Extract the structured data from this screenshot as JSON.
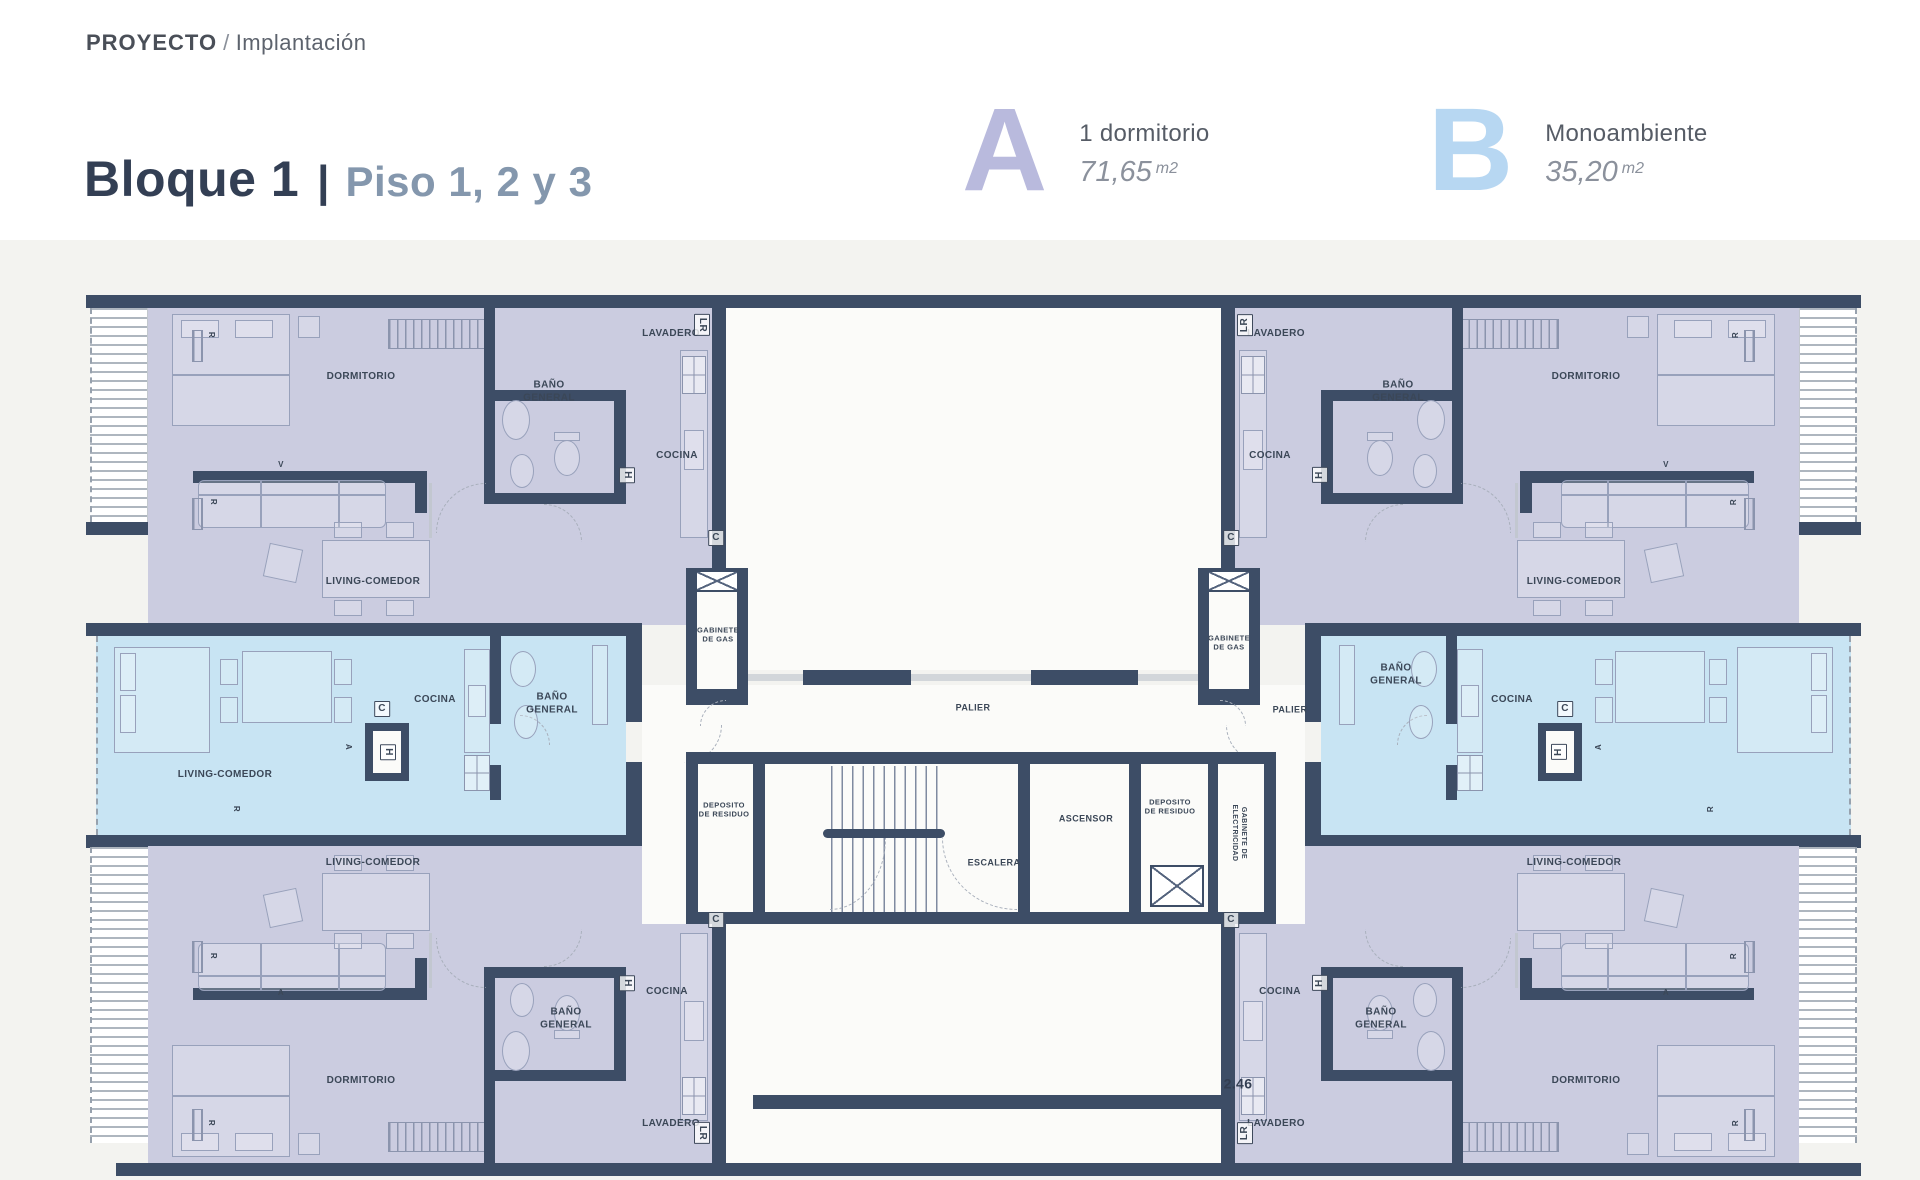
{
  "header": {
    "project_label": "PROYECTO",
    "separator": "/",
    "section_label": "Implantación",
    "block_title": "Bloque 1",
    "title_divider": "|",
    "floors_label": "Piso 1, 2 y 3"
  },
  "legend": [
    {
      "letter": "A",
      "type": "1 dormitorio",
      "area": "71,65",
      "area_unit": "m2",
      "letter_color": "#b9badd"
    },
    {
      "letter": "B",
      "type": "Monoambiente",
      "area": "35,20",
      "area_unit": "m2",
      "letter_color": "#b7d7f2"
    }
  ],
  "plan": {
    "wall_color": "#3d4d66",
    "unit_a_color": "#cbcce0",
    "unit_b_color": "#c8e4f3",
    "dimension": "2.46",
    "labels": [
      {
        "t": "LAVADERO",
        "x": 585,
        "y": 39
      },
      {
        "t": "DORMITORIO",
        "x": 275,
        "y": 82
      },
      {
        "t": "BAÑO\nGENERAL",
        "x": 463,
        "y": 97
      },
      {
        "t": "COCINA",
        "x": 591,
        "y": 161
      },
      {
        "t": "LIVING-COMEDOR",
        "x": 287,
        "y": 287
      },
      {
        "t": "COCINA",
        "x": 349,
        "y": 405
      },
      {
        "t": "BAÑO\nGENERAL",
        "x": 466,
        "y": 409
      },
      {
        "t": "LIVING-COMEDOR",
        "x": 139,
        "y": 480
      },
      {
        "t": "LIVING-COMEDOR",
        "x": 287,
        "y": 568
      },
      {
        "t": "COCINA",
        "x": 581,
        "y": 697
      },
      {
        "t": "BAÑO\nGENERAL",
        "x": 480,
        "y": 724
      },
      {
        "t": "DORMITORIO",
        "x": 275,
        "y": 786
      },
      {
        "t": "LAVADERO",
        "x": 585,
        "y": 829
      },
      {
        "t": "LAVADERO",
        "x": 1190,
        "y": 39
      },
      {
        "t": "DORMITORIO",
        "x": 1500,
        "y": 82
      },
      {
        "t": "BAÑO\nGENERAL",
        "x": 1312,
        "y": 97
      },
      {
        "t": "COCINA",
        "x": 1184,
        "y": 161
      },
      {
        "t": "LIVING-COMEDOR",
        "x": 1488,
        "y": 287
      },
      {
        "t": "BAÑO\nGENERAL",
        "x": 1310,
        "y": 380
      },
      {
        "t": "COCINA",
        "x": 1426,
        "y": 405
      },
      {
        "t": "LIVING-COMEDOR",
        "x": 1488,
        "y": 568
      },
      {
        "t": "COCINA",
        "x": 1194,
        "y": 697
      },
      {
        "t": "BAÑO\nGENERAL",
        "x": 1295,
        "y": 724
      },
      {
        "t": "DORMITORIO",
        "x": 1500,
        "y": 786
      },
      {
        "t": "LAVADERO",
        "x": 1190,
        "y": 829
      },
      {
        "t": "PALIER",
        "x": 887,
        "y": 413,
        "s": 9
      },
      {
        "t": "PALIER",
        "x": 1204,
        "y": 415,
        "s": 9
      },
      {
        "t": "GABINETE\nDE GAS",
        "x": 632,
        "y": 340,
        "s": 7.5
      },
      {
        "t": "GABINETE\nDE GAS",
        "x": 1143,
        "y": 348,
        "s": 7.5
      },
      {
        "t": "DEPOSITO\nDE RESIDUO",
        "x": 638,
        "y": 515,
        "s": 7.5
      },
      {
        "t": "ESCALERA",
        "x": 908,
        "y": 568,
        "s": 9
      },
      {
        "t": "ASCENSOR",
        "x": 1000,
        "y": 524,
        "s": 9
      },
      {
        "t": "DEPOSITO\nDE RESIDUO",
        "x": 1084,
        "y": 512,
        "s": 7.5
      },
      {
        "t": "GABINETE DE\nELECTRICIDAD",
        "x": 1152,
        "y": 538,
        "s": 7,
        "r": 90
      },
      {
        "t": "2.46",
        "x": 1152,
        "y": 789,
        "s": 14,
        "f": 700,
        "c": "#333e52"
      },
      {
        "t": "LR",
        "x": 616,
        "y": 30,
        "r": 90,
        "b": true
      },
      {
        "t": "LR",
        "x": 1159,
        "y": 30,
        "r": -90,
        "b": true
      },
      {
        "t": "LR",
        "x": 616,
        "y": 838,
        "r": 90,
        "b": true
      },
      {
        "t": "LR",
        "x": 1159,
        "y": 838,
        "r": -90,
        "b": true
      },
      {
        "t": "H",
        "x": 541,
        "y": 180,
        "r": 90,
        "b": true
      },
      {
        "t": "H",
        "x": 1234,
        "y": 180,
        "r": -90,
        "b": true
      },
      {
        "t": "H",
        "x": 541,
        "y": 688,
        "r": 90,
        "b": true
      },
      {
        "t": "H",
        "x": 1234,
        "y": 688,
        "r": -90,
        "b": true
      },
      {
        "t": "H",
        "x": 302,
        "y": 457,
        "r": 90,
        "b": true
      },
      {
        "t": "H",
        "x": 1473,
        "y": 457,
        "r": -90,
        "b": true
      },
      {
        "t": "C",
        "x": 630,
        "y": 243,
        "b": true
      },
      {
        "t": "C",
        "x": 1145,
        "y": 243,
        "b": true
      },
      {
        "t": "C",
        "x": 630,
        "y": 625,
        "b": true
      },
      {
        "t": "C",
        "x": 1145,
        "y": 625,
        "b": true
      },
      {
        "t": "C",
        "x": 296,
        "y": 414,
        "b": true
      },
      {
        "t": "C",
        "x": 1479,
        "y": 414,
        "b": true
      },
      {
        "t": "R",
        "x": 125,
        "y": 40,
        "r": 90,
        "s": 8
      },
      {
        "t": "R",
        "x": 127,
        "y": 207,
        "r": 90,
        "s": 8
      },
      {
        "t": "R",
        "x": 1650,
        "y": 40,
        "r": -90,
        "s": 8
      },
      {
        "t": "R",
        "x": 1648,
        "y": 207,
        "r": -90,
        "s": 8
      },
      {
        "t": "R",
        "x": 127,
        "y": 661,
        "r": 90,
        "s": 8
      },
      {
        "t": "R",
        "x": 1648,
        "y": 661,
        "r": -90,
        "s": 8
      },
      {
        "t": "R",
        "x": 125,
        "y": 828,
        "r": 90,
        "s": 8
      },
      {
        "t": "R",
        "x": 1650,
        "y": 828,
        "r": -90,
        "s": 8
      },
      {
        "t": "R",
        "x": 150,
        "y": 514,
        "r": 90,
        "s": 8
      },
      {
        "t": "R",
        "x": 1625,
        "y": 514,
        "r": -90,
        "s": 8
      },
      {
        "t": "V",
        "x": 195,
        "y": 170,
        "s": 8
      },
      {
        "t": "V",
        "x": 1580,
        "y": 170,
        "s": 8
      },
      {
        "t": "A",
        "x": 262,
        "y": 452,
        "r": 90,
        "s": 8
      },
      {
        "t": "A",
        "x": 1513,
        "y": 452,
        "r": -90,
        "s": 8
      },
      {
        "t": "A",
        "x": 195,
        "y": 698,
        "s": 8
      },
      {
        "t": "A",
        "x": 1580,
        "y": 698,
        "s": 8
      }
    ]
  }
}
